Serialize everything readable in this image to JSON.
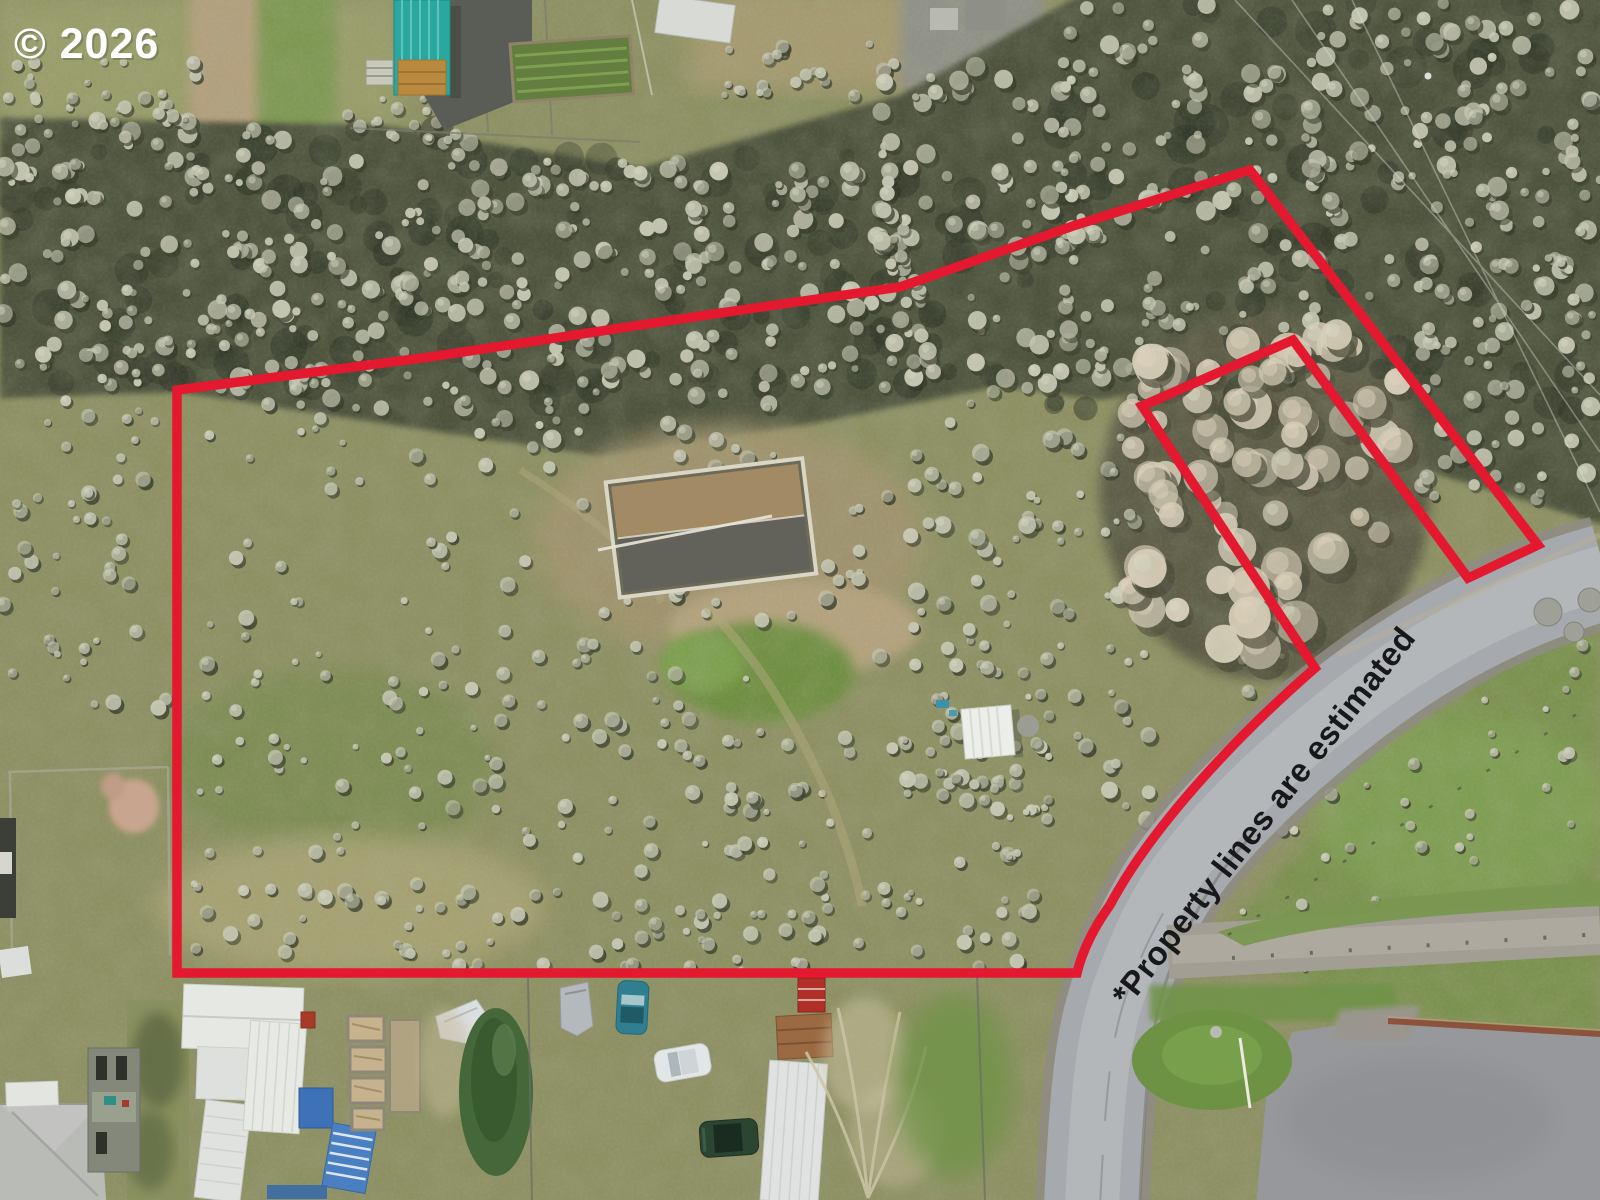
{
  "image": {
    "kind": "aerial-drone-photograph",
    "width_px": 1600,
    "height_px": 1200,
    "subject": "rural acreage with red outlined property boundary, country road and homestead"
  },
  "annotations": {
    "copyright": "© 2026",
    "copyright_color": "#ffffff",
    "disclaimer": "*Property lines are estimated",
    "disclaimer_color": "#17181a"
  },
  "colors": {
    "boundary_red": "#e4182e",
    "road_asphalt": "#a6a9ad",
    "road_center": "#b5b8bb",
    "road_shoulder": "#8f8c85",
    "branch_road": "#a39e94",
    "gravel_parking": "#96989b",
    "field_base": "#8d9063",
    "scrub_dark": "#4d523c",
    "bush_light": "#c6c8b4",
    "bush_shadow": "#343a28",
    "thicket_light": "#d6cdb8",
    "grass_bright": "#79944c",
    "dirt_tan": "#b2a07e",
    "teal_shed": "#2aa79e",
    "retaining_wall": "#8c523c"
  }
}
